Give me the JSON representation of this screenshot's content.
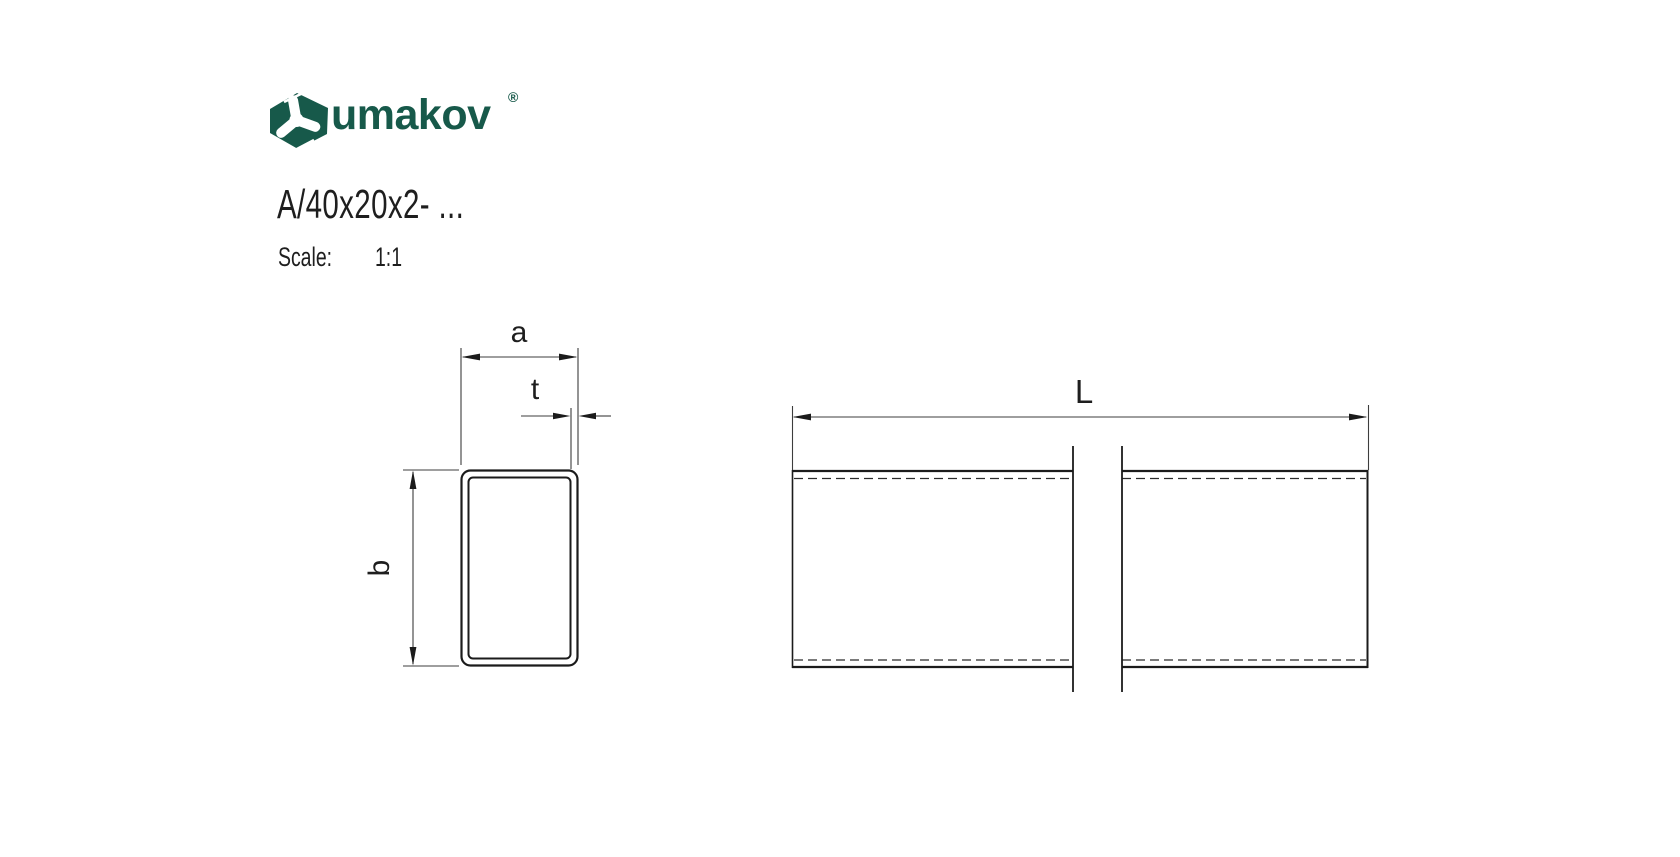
{
  "brand": {
    "name": "umakov",
    "registered": "®",
    "color": "#17594a",
    "icon": "umakov-hexagon-logo"
  },
  "drawing": {
    "title": "A/40x20x2- ...",
    "scale_label": "Scale:",
    "scale_value": "1:1"
  },
  "dimensions": {
    "width_label": "a",
    "thickness_label": "t",
    "height_label": "b",
    "length_label": "L"
  }
}
